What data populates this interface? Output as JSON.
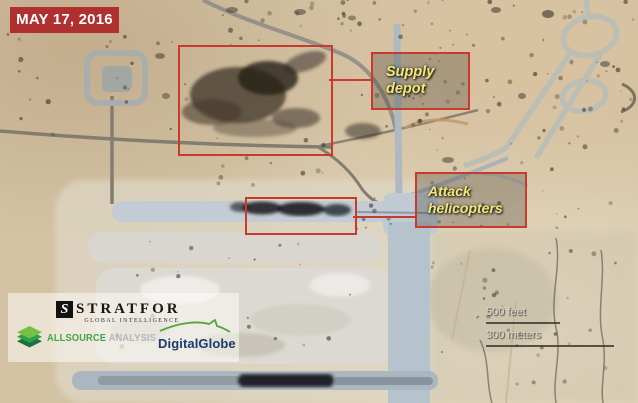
{
  "banner": {
    "date": "MAY 17, 2016"
  },
  "annotations": {
    "supply_depot": {
      "label": "Supply\ndepot"
    },
    "attack_helicopters": {
      "label": "Attack\nhelicopters"
    }
  },
  "scale_bar": {
    "feet_label": "500 feet",
    "meters_label": "300 meters"
  },
  "credits": {
    "stratfor": {
      "icon_letter": "S",
      "name": "STRATFOR",
      "tagline": "GLOBAL INTELLIGENCE"
    },
    "allsource": {
      "name_primary": "ALLSOURCE",
      "name_secondary": "ANALYSIS"
    },
    "digitalglobe": {
      "name": "DigitalGlobe"
    }
  },
  "colors": {
    "annotation_red": "#c8392e",
    "banner_red": "#b02f2f",
    "label_text_yellow": "#f1e878",
    "desert_tan": "#d3c2a4",
    "pavement_blue_gray": "#aab7c1",
    "allsource_green": "#43a44c",
    "digitalglobe_navy": "#1c3a6b"
  }
}
